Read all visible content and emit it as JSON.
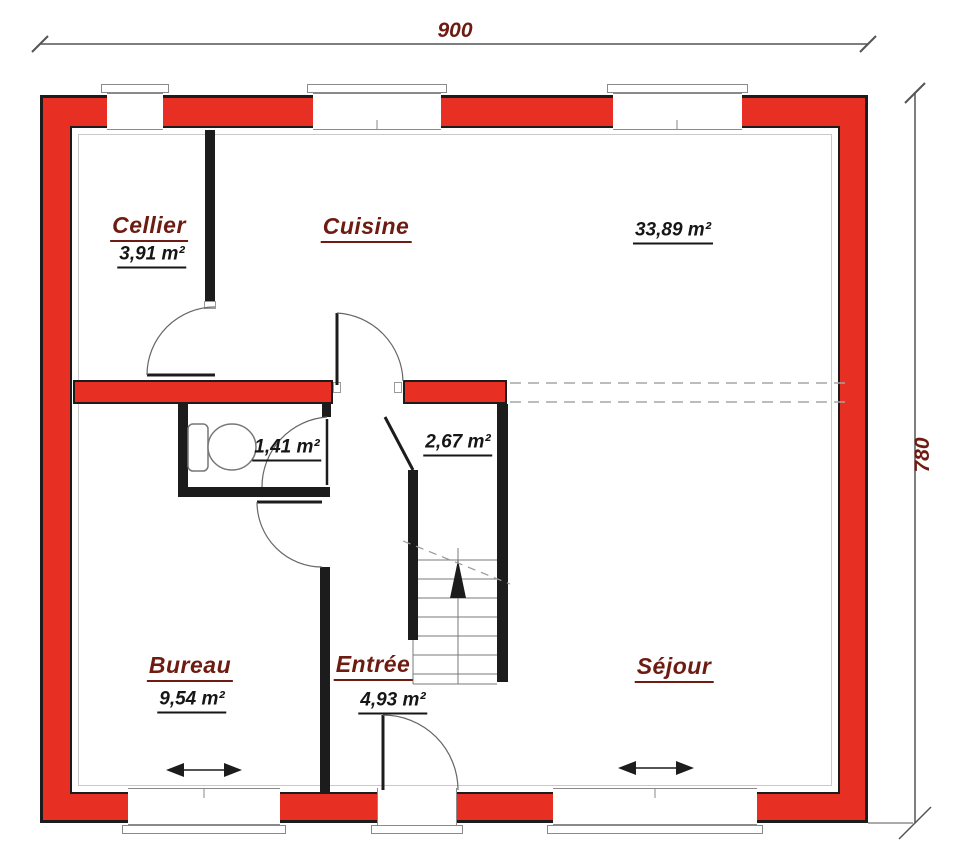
{
  "colors": {
    "wall_red": "#e73023",
    "outline_black": "#1c1c1c",
    "label_red": "#6e1b12",
    "thin_gray": "#8a8a8a",
    "dim_gray": "#555555"
  },
  "dimensions": {
    "top": "900",
    "right": "780"
  },
  "rooms": {
    "cellier": {
      "name": "Cellier",
      "area": "3,91 m²"
    },
    "cuisine": {
      "name": "Cuisine"
    },
    "cuisine_sejour": {
      "area": "33,89 m²"
    },
    "wc": {
      "area": "1,41 m²"
    },
    "stair_hall": {
      "area": "2,67 m²"
    },
    "bureau": {
      "name": "Bureau",
      "area": "9,54 m²"
    },
    "entree": {
      "name": "Entrée",
      "area": "4,93 m²"
    },
    "sejour": {
      "name": "Séjour"
    }
  }
}
